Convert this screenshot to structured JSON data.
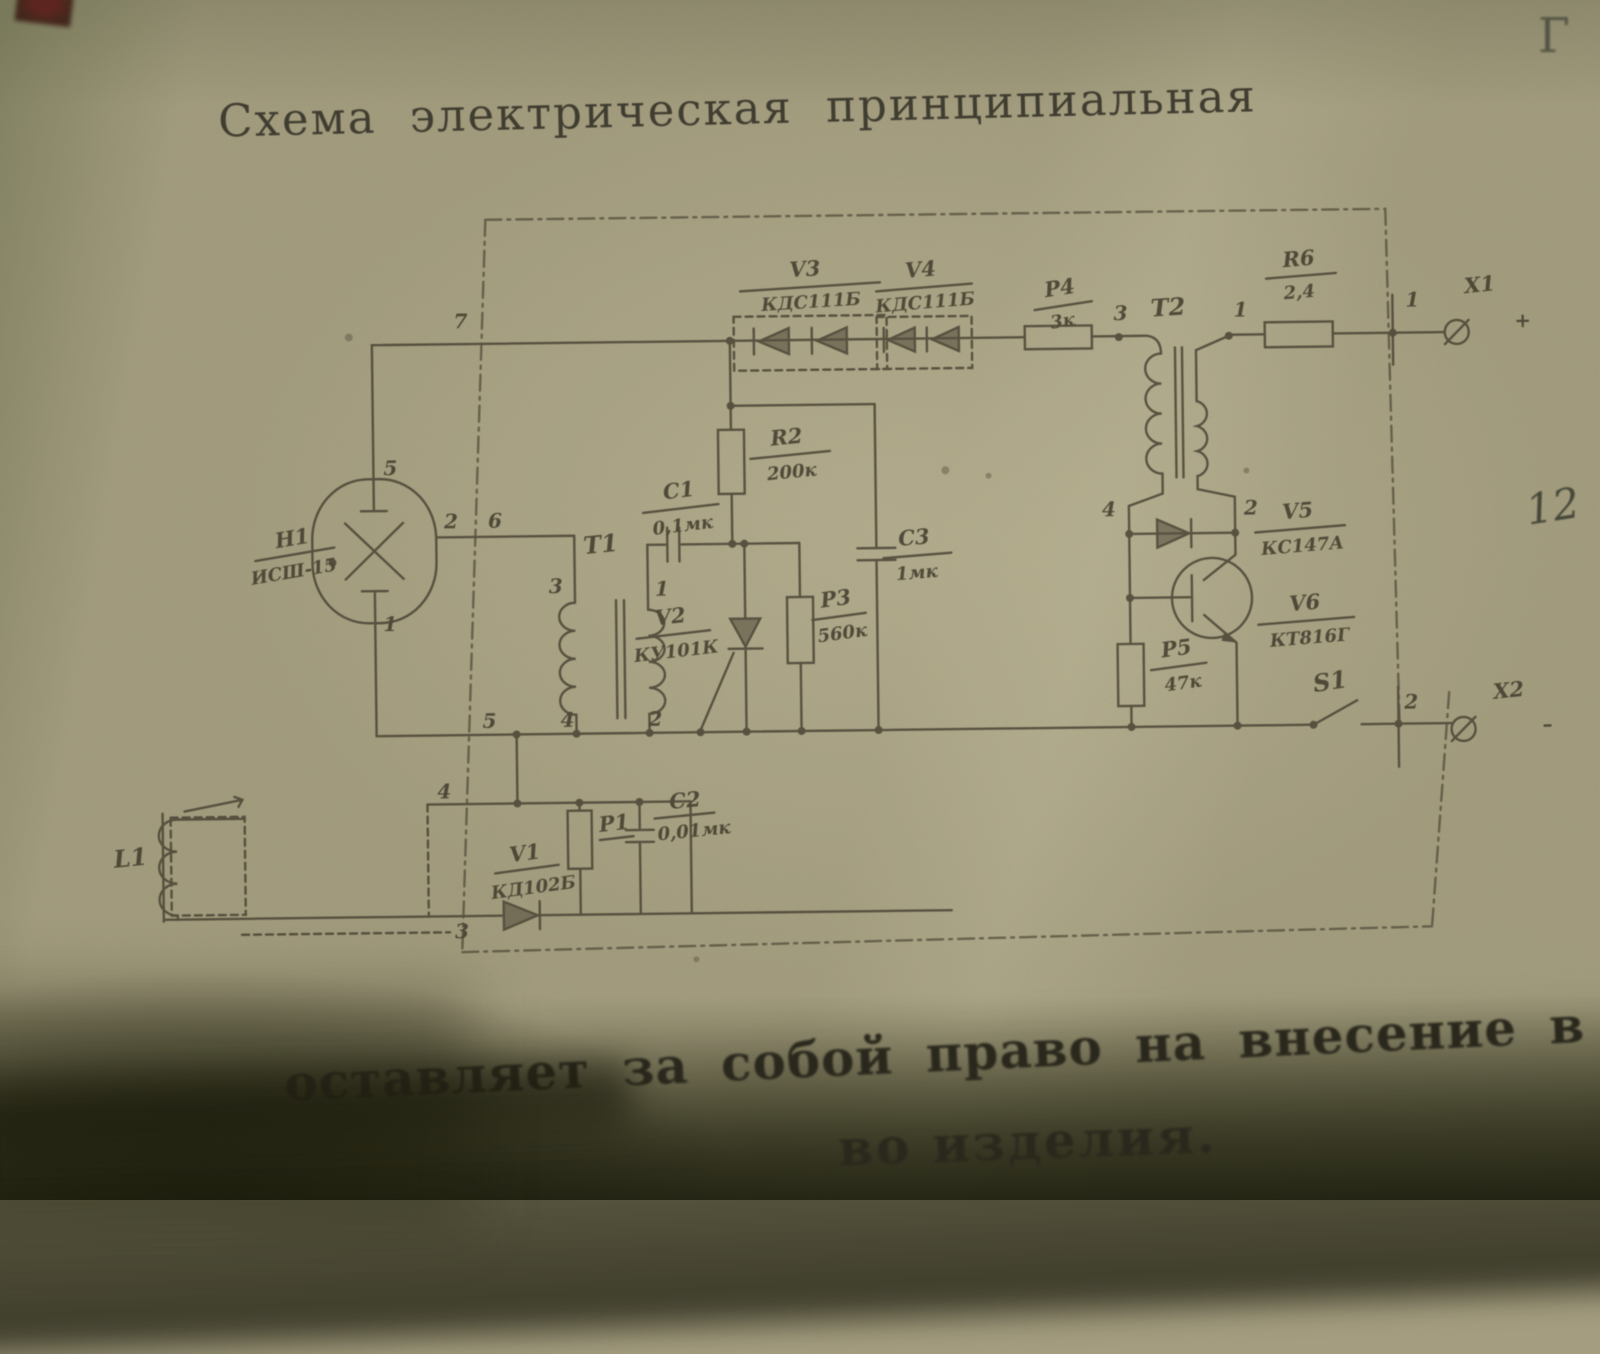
{
  "title": "Схема электрическая принципиальная",
  "marginalia": {
    "top_right_letter": "Г",
    "right_edge_number": "12",
    "footer_line1": "оставляет за собой право на внесение в схем",
    "footer_line2": "во изделия."
  },
  "components": {
    "h1": {
      "ref": "Н1",
      "value": "ИСШ-15"
    },
    "l1": {
      "ref": "L1"
    },
    "t1": {
      "ref": "Т1"
    },
    "t2": {
      "ref": "Т2"
    },
    "s1": {
      "ref": "S1"
    },
    "x1": {
      "ref": "Х1"
    },
    "x2": {
      "ref": "Х2"
    },
    "v1": {
      "ref": "V1",
      "value": "КД102Б"
    },
    "v2": {
      "ref": "V2",
      "value": "КУ101К"
    },
    "v3": {
      "ref": "V3",
      "value": "КДС111Б"
    },
    "v4": {
      "ref": "V4",
      "value": "КДС111Б"
    },
    "v5": {
      "ref": "V5",
      "value": "КС147А"
    },
    "v6": {
      "ref": "V6",
      "value": "КТ816Г"
    },
    "r1": {
      "ref": "Р1"
    },
    "r2": {
      "ref": "R2",
      "value": "200к"
    },
    "r3": {
      "ref": "Р3",
      "value": "560к"
    },
    "r4": {
      "ref": "Р4",
      "value": "3к"
    },
    "r5": {
      "ref": "Р5",
      "value": "47к"
    },
    "r6": {
      "ref": "R6",
      "value": "2,4"
    },
    "c1": {
      "ref": "С1",
      "value": "0,1мк"
    },
    "c2": {
      "ref": "С2",
      "value": "0,01мк"
    },
    "c3": {
      "ref": "С3",
      "value": "1мк"
    }
  },
  "pins": {
    "top_bus_node": "7",
    "lamp_top": "5",
    "lamp_bottom": "1",
    "lamp_right": "2",
    "frame_cross": "6",
    "t1_top_left": "3",
    "t1_top_right": "1",
    "bus_left": "5",
    "bus_mid": "4",
    "bus_right": "2",
    "trigger_node": "4",
    "trigger_gnd": "3",
    "t2_in": "3",
    "t2_out": "1",
    "x1_pin": "1",
    "x1_polarity": "+",
    "v5_anode": "4",
    "v5_cathode": "2",
    "x2_pin": "2",
    "x2_polarity": "–"
  }
}
